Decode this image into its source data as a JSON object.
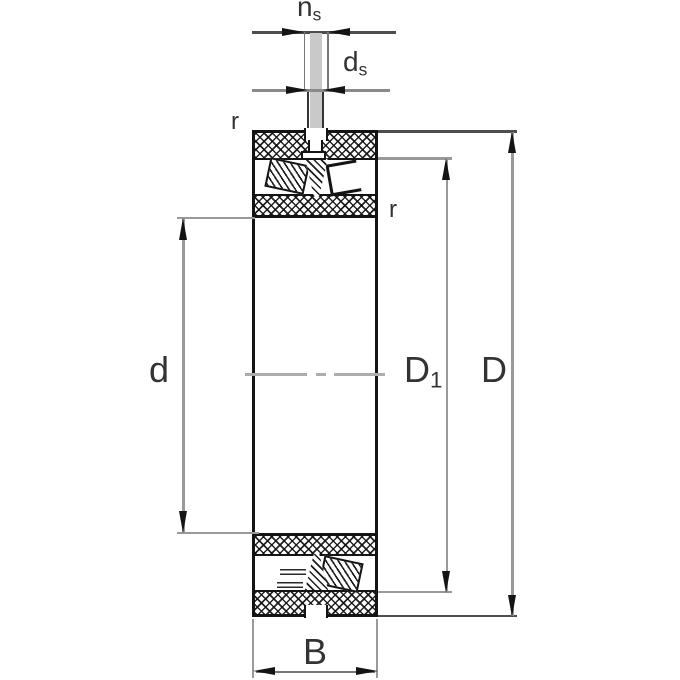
{
  "labels": {
    "ns": {
      "main": "n",
      "sub": "s"
    },
    "ds": {
      "main": "d",
      "sub": "s"
    },
    "r_outer": "r",
    "r_inner": "r",
    "d": "d",
    "D1": {
      "main": "D",
      "sub": "1"
    },
    "D": "D",
    "B": "B"
  },
  "colors": {
    "outline": "#141414",
    "dimension_line": "#999999",
    "dark_extension_line": "#4d4d4d",
    "centerline": "#adadad",
    "hole_fill": "#c9c9c9",
    "label_text": "#333333",
    "background": "#ffffff"
  }
}
